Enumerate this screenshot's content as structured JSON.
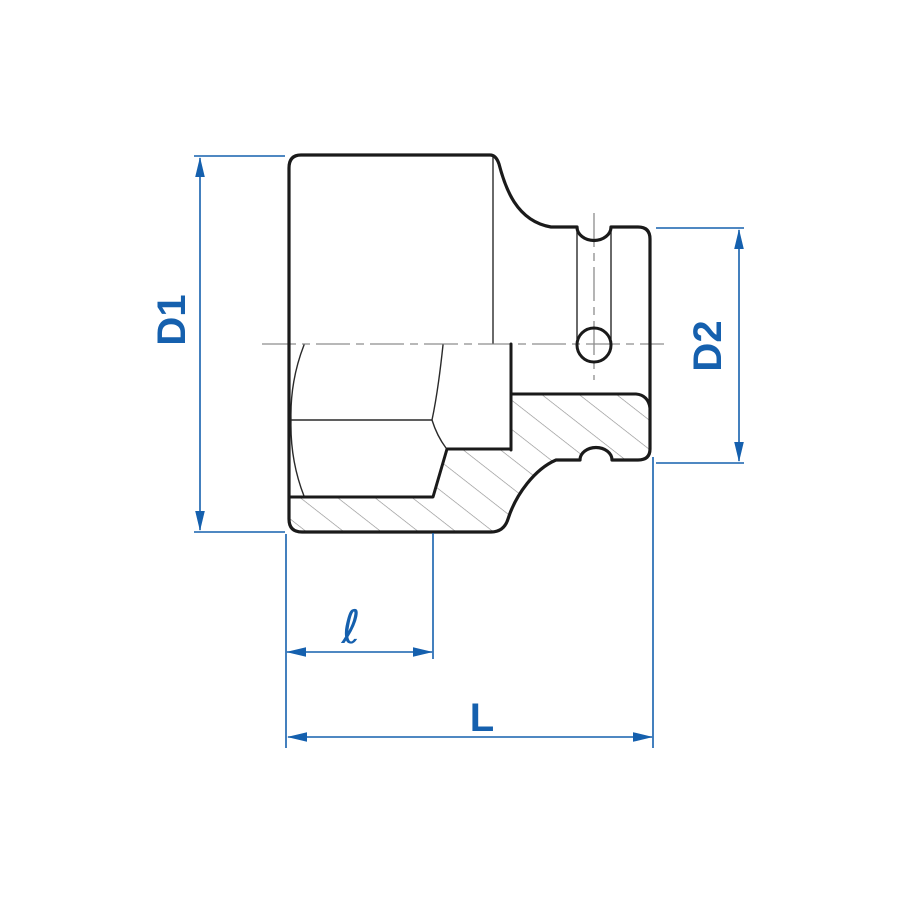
{
  "diagram": {
    "type": "technical-drawing",
    "subject": "impact-socket side cross-section with dimension callouts",
    "dimension_labels": {
      "d1": "D1",
      "d2": "D2",
      "hex_depth": "ℓ",
      "overall_length": "L"
    },
    "colors": {
      "dimension": "#1560ae",
      "outline": "#1a1a1a",
      "thin_line": "#2a2a2a",
      "hatch": "#8e8e8e",
      "centerline": "#8d8d8d",
      "background": "#ffffff"
    }
  }
}
